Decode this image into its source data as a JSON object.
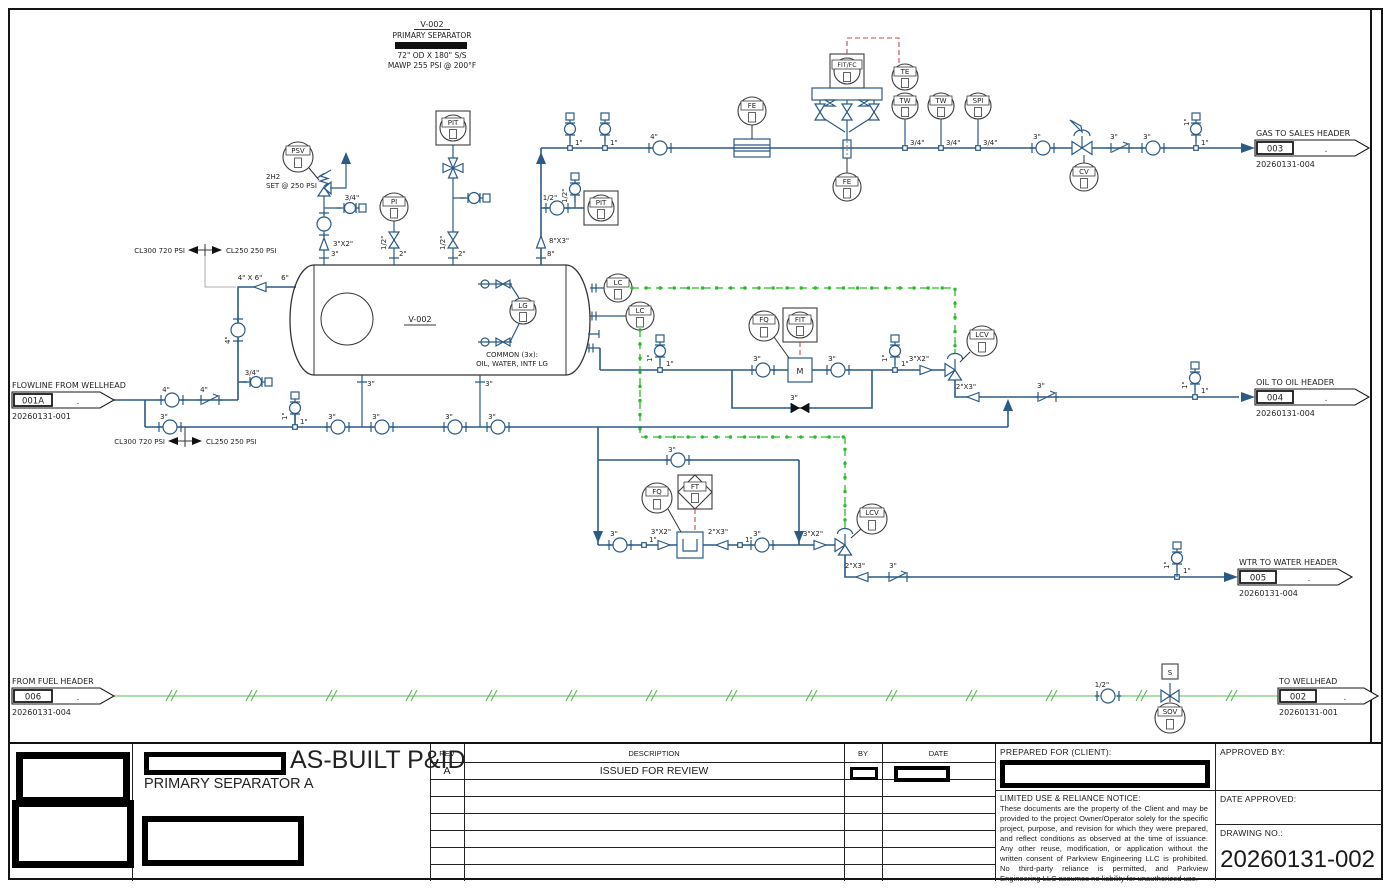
{
  "page": {
    "doc_type": "AS-BUILT P&ID",
    "doc_subtitle": "PRIMARY SEPARATOR A",
    "drawing_no": "20260131-002"
  },
  "equipment_note": {
    "tag": "V-002",
    "name": "PRIMARY SEPARATOR",
    "size": "72\" OD X 180\" S/S",
    "rating": "MAWP 255 PSI @ 200°F"
  },
  "vessel": {
    "tag": "V-002",
    "lg_note1": "COMMON (3x):",
    "lg_note2": "OIL, WATER, INTF LG"
  },
  "psv_note": {
    "line1": "2H2",
    "line2": "SET @ 250 PSI"
  },
  "spec_breaks": {
    "left": "CL300 720 PSI",
    "right": "CL250 250 PSI"
  },
  "connectors": {
    "flowline_in": {
      "title": "FLOWLINE FROM WELLHEAD",
      "num": "001A",
      "dot": ".",
      "dwg": "20260131-001"
    },
    "gas_out": {
      "title": "GAS TO SALES HEADER",
      "num": "003",
      "dot": ".",
      "dwg": "20260131-004"
    },
    "oil_out": {
      "title": "OIL TO OIL HEADER",
      "num": "004",
      "dot": ".",
      "dwg": "20260131-004"
    },
    "water_out": {
      "title": "WTR TO WATER HEADER",
      "num": "005",
      "dot": ".",
      "dwg": "20260131-004"
    },
    "fuel_in": {
      "title": "FROM FUEL HEADER",
      "num": "006",
      "dot": ".",
      "dwg": "20260131-004"
    },
    "wellhead_out": {
      "title": "TO WELLHEAD",
      "num": "002",
      "dot": ".",
      "dwg": "20260131-001"
    }
  },
  "tags": {
    "psv": "PSV",
    "pi": "PI",
    "pit": "PIT",
    "fe": "FE",
    "fit_fc": "FIT/FC",
    "te": "TE",
    "tw": "TW",
    "spi": "SPI",
    "cv": "CV",
    "lc": "LC",
    "lg": "LG",
    "fq": "FQ",
    "fit": "FIT",
    "ft": "FT",
    "lcv": "LCV",
    "m": "M",
    "s": "S",
    "sov": "SOV"
  },
  "sizes": {
    "half": "1/2\"",
    "three_quarter": "3/4\"",
    "one": "1\"",
    "two": "2\"",
    "three": "3\"",
    "four": "4\"",
    "six": "6\"",
    "eight": "8\"",
    "r3x2": "3\"X2\"",
    "r2x3": "2\"X3\"",
    "r8x3": "8\"X3\"",
    "r4x6": "4\" X 6\""
  },
  "title_block": {
    "rev_col": "REV",
    "desc_col": "DESCRIPTION",
    "by_col": "BY",
    "date_col": "DATE",
    "rev_a": "A",
    "rev_a_desc": "ISSUED FOR REVIEW",
    "prepared_for": "PREPARED FOR (CLIENT):",
    "approved_by": "APPROVED BY:",
    "date_approved": "DATE APPROVED:",
    "drawing_no_label": "DRAWING NO.:",
    "drawing_no": "20260131-002",
    "notice_title": "LIMITED USE & RELIANCE NOTICE:",
    "notice_body": "These documents are the property of the Client and may be provided to the project Owner/Operator solely for the specific project, purpose, and revision for which they were prepared, and reflect conditions as observed at the time of issuance. Any other reuse, modification, or application without the written consent of Parkview Engineering LLC is prohibited. No third-party reliance is permitted, and Parkview Engineering LLC assumes no liability for unauthorized use."
  },
  "colors": {
    "pipe": "#2b5a87",
    "signal_green": "#2dbb2d",
    "fuel_green": "#8fd48f",
    "instr_red": "#c14b4b",
    "ink": "#1a1a1a"
  }
}
